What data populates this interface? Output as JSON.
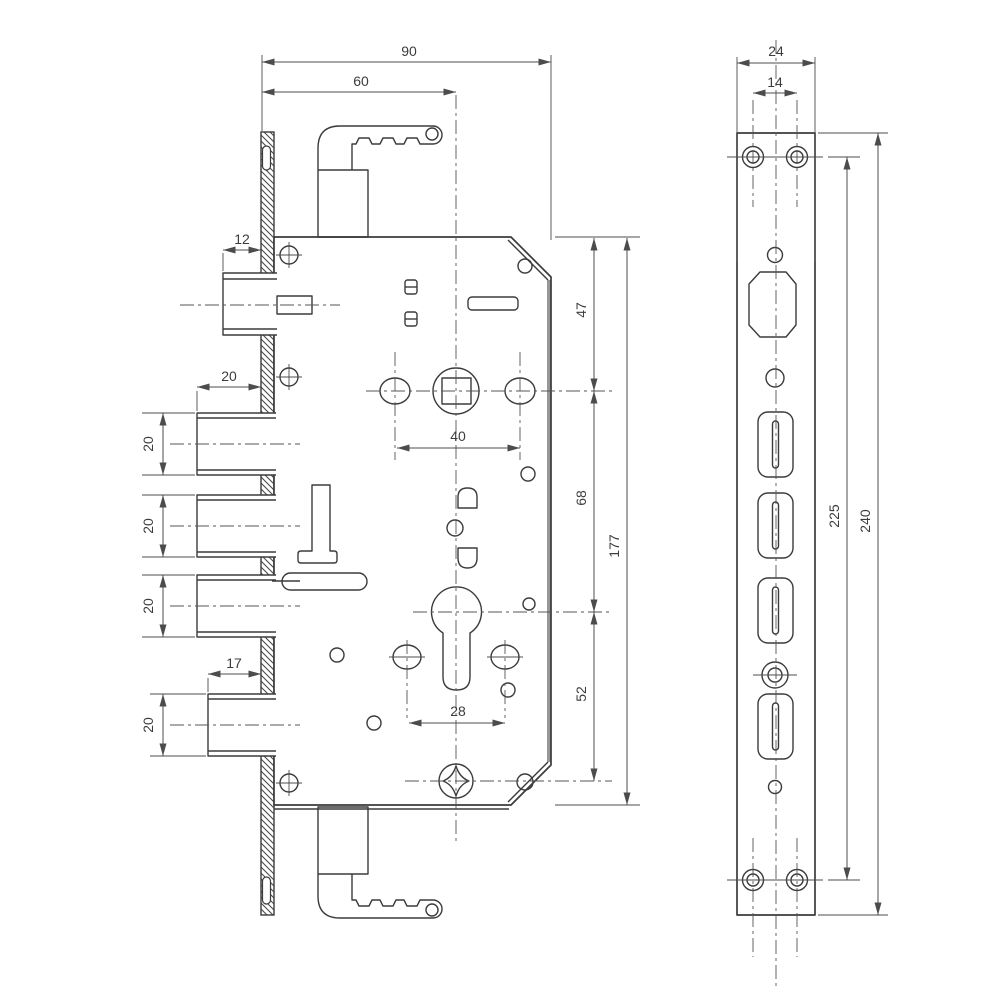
{
  "drawing_title": "Mortise lock dimensional drawing",
  "colors": {
    "line": "#3b3b3b",
    "dim": "#4c4c4c",
    "edge_gray": "#979797",
    "background": "#ffffff"
  },
  "side_view": {
    "dims": {
      "case_depth": "90",
      "backset": "60",
      "latch_width": "12",
      "bolt_width": "20",
      "bottom_bolt_width": "17",
      "handle_screw_spacing": "40",
      "cylinder_screw_spacing": "28",
      "bolt1_height": "20",
      "bolt2_height": "20",
      "bolt3_height": "20",
      "bolt4_height": "20",
      "top_to_spindle": "47",
      "spindle_to_cylinder": "68",
      "cylinder_to_adjuster": "52",
      "case_height": "177"
    }
  },
  "faceplate_view": {
    "dims": {
      "plate_width": "24",
      "screw_spacing": "14",
      "screw_hole_span": "225",
      "plate_length": "240"
    }
  }
}
